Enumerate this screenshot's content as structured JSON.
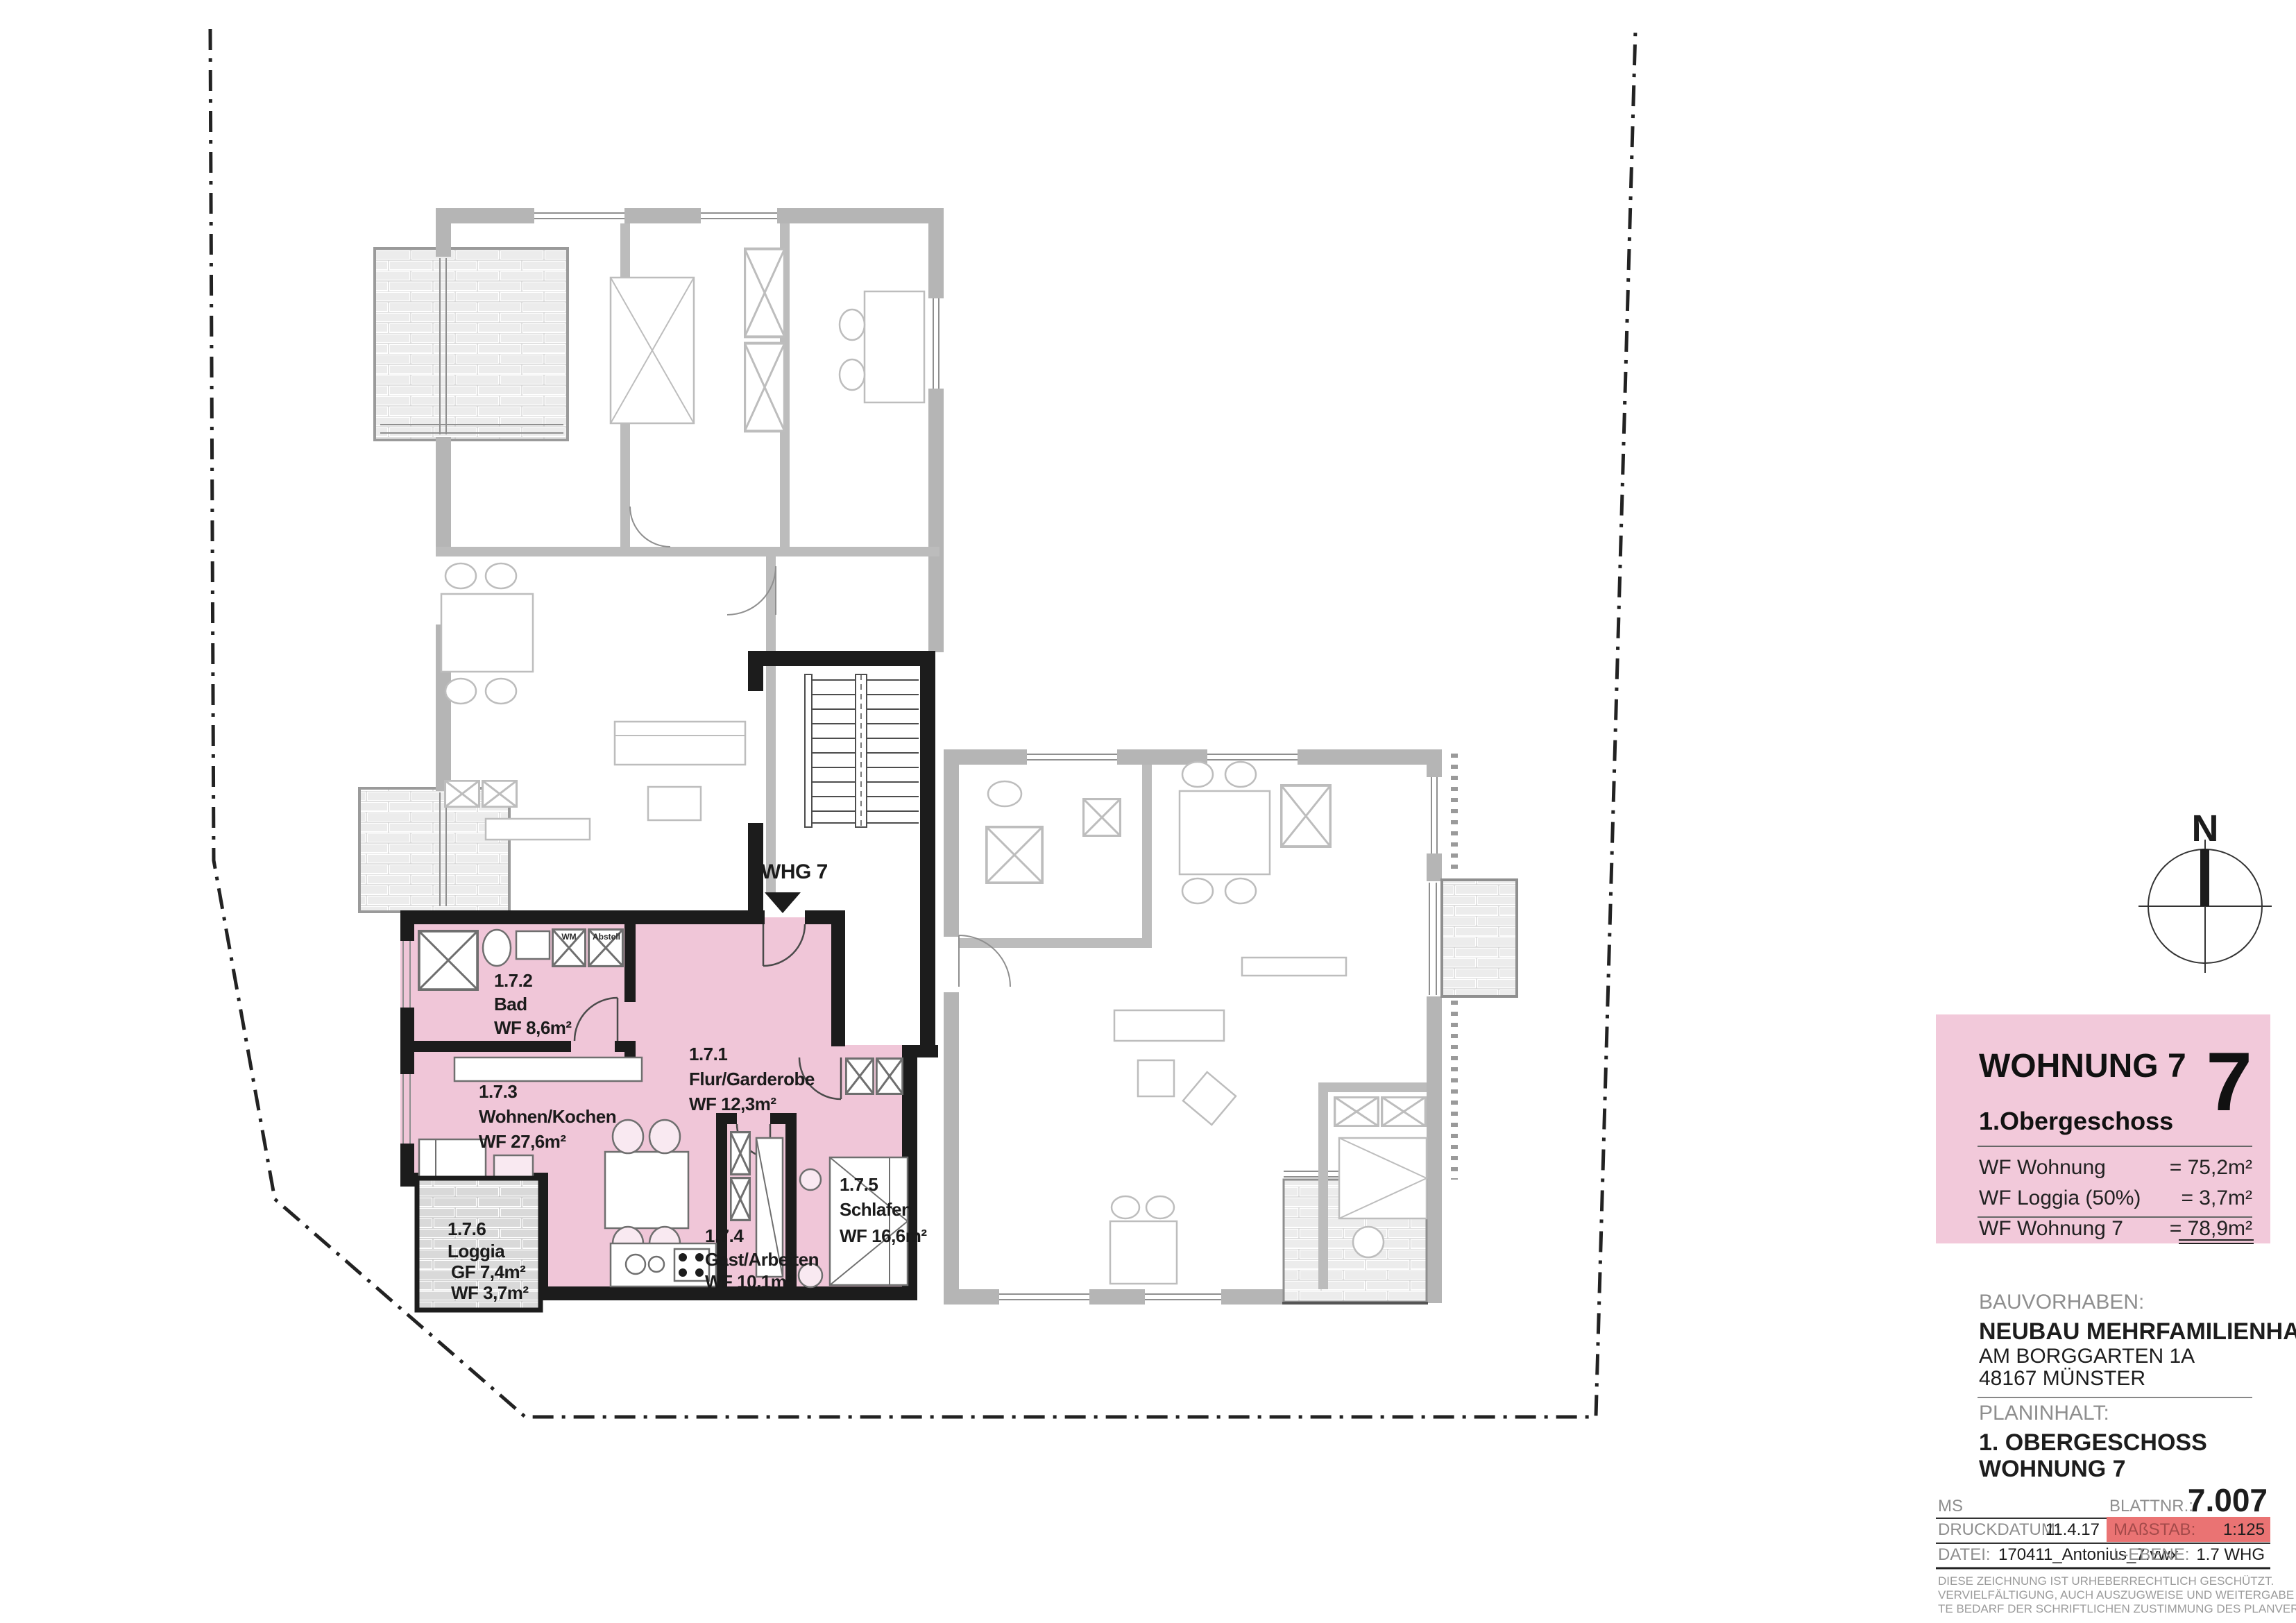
{
  "sheet": {
    "north_label": "N",
    "entrance_label": "WHG 7"
  },
  "rooms": [
    {
      "id": "1.7.1",
      "name": "Flur/Garderobe",
      "area": "WF 12,3m²"
    },
    {
      "id": "1.7.2",
      "name": "Bad",
      "area": "WF 8,6m²"
    },
    {
      "id": "1.7.3",
      "name": "Wohnen/Kochen",
      "area": "WF 27,6m²"
    },
    {
      "id": "1.7.4",
      "name": "Gast/Arbeiten",
      "area": "WF 10,1m²"
    },
    {
      "id": "1.7.5",
      "name": "Schlafen",
      "area": "WF 16,6m²"
    },
    {
      "id": "1.7.6",
      "name": "Loggia",
      "area_gf": "GF 7,4m²",
      "area_wf": "WF 3,7m²"
    }
  ],
  "closets": {
    "wm": "WM",
    "abstell": "Abstell"
  },
  "title_block": {
    "title": "WOHNUNG 7",
    "big_number": "7",
    "floor": "1.Obergeschoss",
    "rows": [
      {
        "label": "WF Wohnung",
        "value": "= 75,2m²"
      },
      {
        "label": "WF Loggia (50%)",
        "value": "=  3,7m²"
      },
      {
        "label": "WF Wohnung 7",
        "value": "= 78,9m²"
      }
    ]
  },
  "project": {
    "bauvorhaben_label": "BAUVORHABEN:",
    "name": "NEUBAU MEHRFAMILIENHAUS",
    "street": "AM BORGGARTEN 1A",
    "city": "48167 MÜNSTER",
    "planinhalt_label": "PLANINHALT:",
    "content_line1": "1. OBERGESCHOSS",
    "content_line2": "WOHNUNG 7"
  },
  "meta": {
    "ms": "MS",
    "blattnr_label": "BLATTNR.:",
    "blattnr": "7.007",
    "druckdatum_label": "DRUCKDATUM:",
    "druckdatum": "11.4.17",
    "massstab_label": "MAßSTAB:",
    "massstab": "1:125",
    "datei_label": "DATEI:",
    "datei": "170411_Antonius_7.vwx",
    "lebene_label": "L-EBENE:",
    "lebene": "1.7 WHG",
    "copyright1": "DIESE ZEICHNUNG IST URHEBERRECHTLICH GESCHÜTZT.",
    "copyright2": "VERVIELFÄLTIGUNG, AUCH AUSZUGWEISE UND WEITERGABE AN  DRIT-",
    "copyright3": "TE BEDARF DER SCHRIFTLICHEN ZUSTIMMUNG DES PLANVERFASSERS."
  },
  "colors": {
    "apartment_pink": "#f0c6d8",
    "panel_pink": "#f2c9da",
    "scale_red": "#ea7373",
    "wall_black": "#1c1c1c",
    "wall_gray": "#b5b5b5"
  }
}
